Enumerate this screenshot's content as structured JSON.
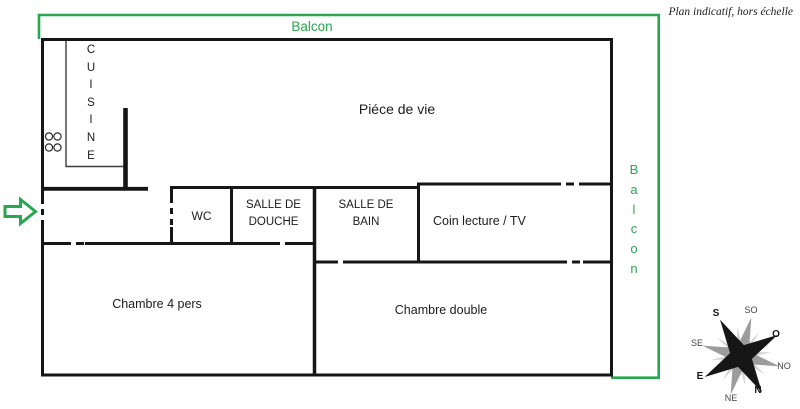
{
  "note": "Plan indicatif, hors échelle",
  "balcony": {
    "top_label": "Balcon",
    "right_label_stacked": "B\na\nl\nc\no\nn"
  },
  "rooms": {
    "cuisine_stacked": "C\nU\nI\nS\nI\nN\nE",
    "piece_de_vie": "Piéce de vie",
    "wc": "WC",
    "salle_de_douche_l1": "SALLE DE",
    "salle_de_douche_l2": "DOUCHE",
    "salle_de_bain_l1": "SALLE DE",
    "salle_de_bain_l2": "BAIN",
    "coin_lecture": "Coin lecture / TV",
    "chambre_4_pers": "Chambre 4 pers",
    "chambre_double": "Chambre double"
  },
  "compass": {
    "n": "N",
    "s": "S",
    "e": "E",
    "o": "O",
    "ne": "NE",
    "no": "NO",
    "se": "SE",
    "so": "SO"
  },
  "colors": {
    "balcony_green": "#28a74f",
    "wall_black": "#161616",
    "compass_gray": "#9c9c9c"
  }
}
